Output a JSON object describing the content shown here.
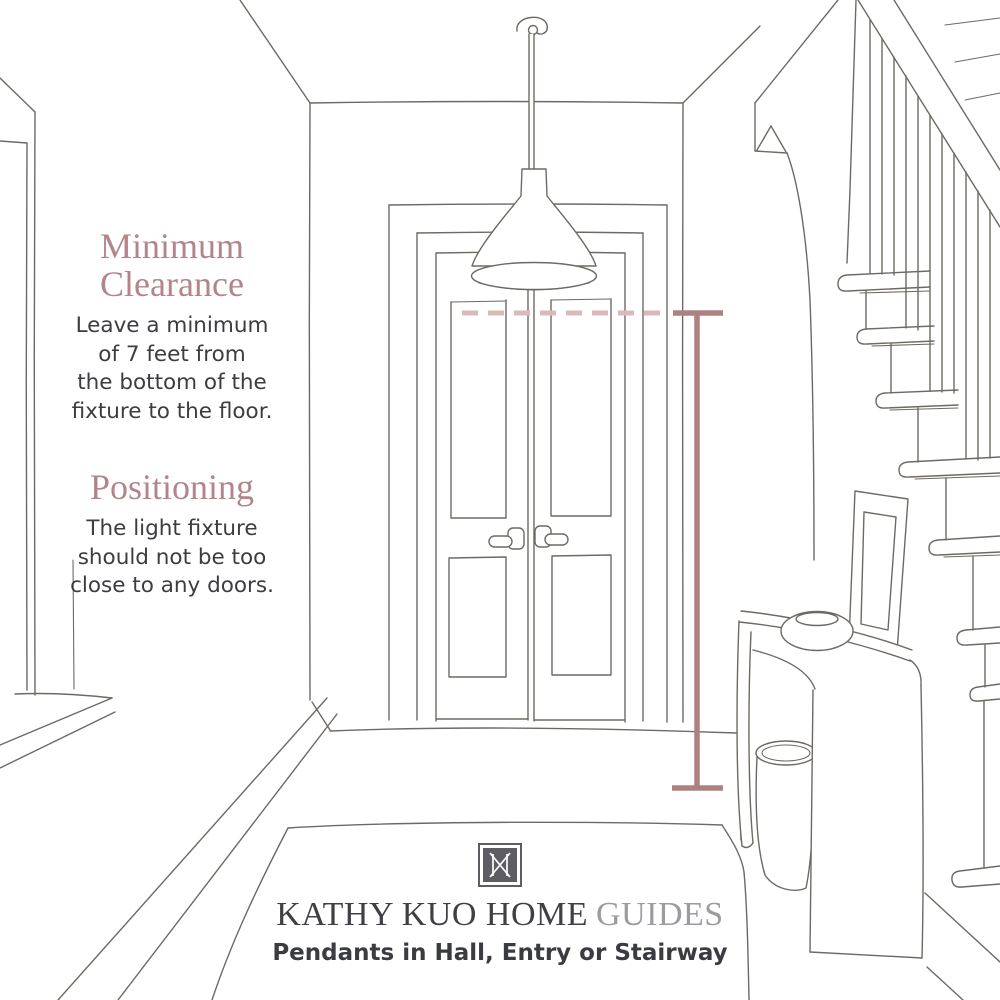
{
  "annotations": {
    "minimum_clearance": {
      "heading_lines": [
        "Minimum",
        "Clearance"
      ],
      "body_lines": [
        "Leave a minimum",
        "of 7 feet from",
        "the bottom of the",
        "fixture to the floor."
      ]
    },
    "positioning": {
      "heading_lines": [
        "Positioning"
      ],
      "body_lines": [
        "The light fixture",
        "should not be too",
        "close to any doors."
      ]
    }
  },
  "measurement": {
    "minimum_clearance_feet": "7",
    "dashed_reference_line": "pendant bottom reference",
    "vertical_line": "7 feet floor clearance"
  },
  "footer": {
    "logo_icon": "kk-monogram",
    "brand": "KATHY KUO HOME",
    "collection": "GUIDES",
    "subtitle": "Pendants in Hall, Entry or Stairway"
  },
  "scene": {
    "description": "hand-sketched hallway with double doors, pendant light, staircase, console table, basket, picture frame and rug"
  },
  "colors": {
    "rose": "#b3858b",
    "body_text": "#3c3c41",
    "sketch_line": "#6e6963",
    "measure_solid": "#ae8181",
    "measure_dashed": "#dab9ba",
    "logo": "#5e5d63",
    "title_text": "#3f4045",
    "guides_text": "#9b9ba2",
    "subtitle_text": "#3b3c42"
  }
}
